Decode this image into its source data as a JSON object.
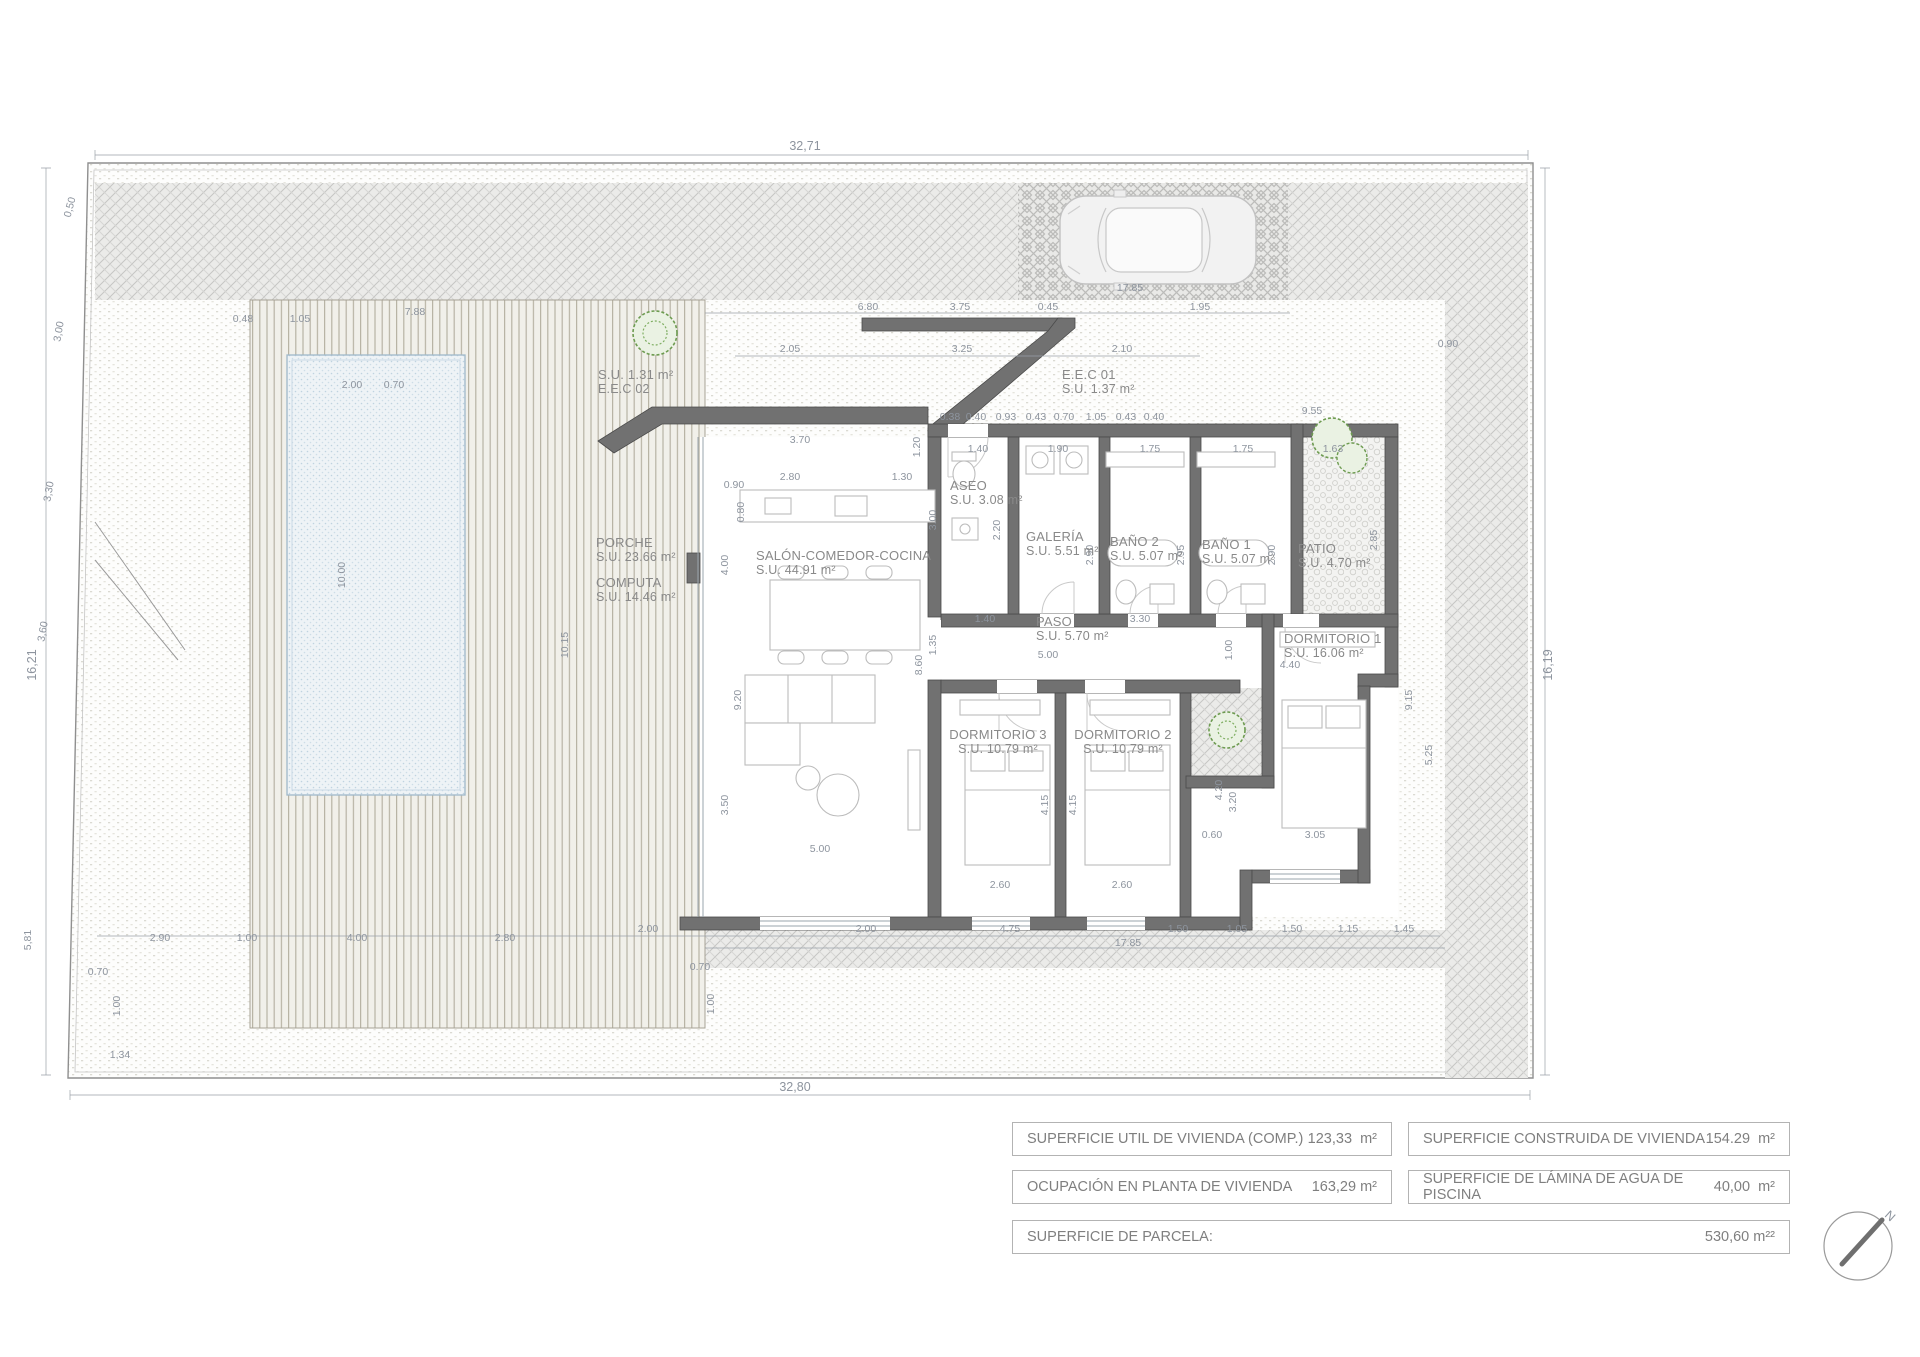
{
  "colors": {
    "wall_fill": "#717171",
    "wall_stroke": "#4a4a4a",
    "dimension_text": "#8d949e",
    "room_label_text": "#898989",
    "pool_fill": "#eef3f6",
    "pool_dot": "#bfd3e0",
    "deck_line": "#b7b3a4",
    "gravel_hatch": "#c6c6c4",
    "tree_green": "#5f8f45",
    "table_border": "#b3b3b3",
    "table_text": "#7f7f7f"
  },
  "icons": {
    "car": "car-top-view",
    "tree": "tree-canopy-plan",
    "compass": "north-arrow-compass"
  },
  "plan": {
    "compass_label": "N",
    "rooms": [
      {
        "n": "PORCHE",
        "s": "S.U. 23.66 m²",
        "x": 596,
        "y": 547
      },
      {
        "n": "COMPUTA",
        "s": "S.U. 14.46 m²",
        "x": 596,
        "y": 587
      },
      {
        "n": "SALÓN-COMEDOR-COCINA",
        "s": "S.U. 44.91 m²",
        "x": 756,
        "y": 560
      },
      {
        "n": "ASEO",
        "s": "S.U. 3.08 m²",
        "x": 950,
        "y": 490
      },
      {
        "n": "GALERÍA",
        "s": "S.U. 5.51 m²",
        "x": 1026,
        "y": 541
      },
      {
        "n": "BAÑO 2",
        "s": "S.U. 5.07 m²",
        "x": 1110,
        "y": 546
      },
      {
        "n": "BAÑO 1",
        "s": "S.U. 5.07 m²",
        "x": 1202,
        "y": 549
      },
      {
        "n": "PATIO",
        "s": "S.U. 4.70 m²",
        "x": 1298,
        "y": 553
      },
      {
        "n": "PASO",
        "s": "S.U. 5.70 m²",
        "x": 1036,
        "y": 626
      },
      {
        "n": "DORMITORIO 3",
        "s": "S.U. 10.79 m²",
        "x": 998,
        "y": 739,
        "a": "middle"
      },
      {
        "n": "DORMITORIO 2",
        "s": "S.U. 10.79 m²",
        "x": 1123,
        "y": 739,
        "a": "middle"
      },
      {
        "n": "DORMITORIO 1",
        "s": "S.U. 16.06 m²",
        "x": 1284,
        "y": 643
      },
      {
        "n": "E.E.C 01",
        "s": "S.U. 1.37 m²",
        "x": 1062,
        "y": 379
      },
      {
        "n": "S.U. 1.31 m²",
        "s": "E.E.C 02",
        "x": 598,
        "y": 379
      }
    ],
    "dims": [
      {
        "t": "32,71",
        "x": 805,
        "y": 150,
        "s": 12.5
      },
      {
        "t": "32,80",
        "x": 795,
        "y": 1091,
        "s": 12.5
      },
      {
        "t": "16,21",
        "x": 36,
        "y": 665,
        "r": -90,
        "s": 12.5
      },
      {
        "t": "16,19",
        "x": 1552,
        "y": 665,
        "r": -90,
        "s": 12.5
      },
      {
        "t": "0,50",
        "x": 73,
        "y": 208,
        "r": -75
      },
      {
        "t": "3,00",
        "x": 62,
        "y": 332,
        "r": -80
      },
      {
        "t": "3,30",
        "x": 52,
        "y": 492,
        "r": -80
      },
      {
        "t": "3,60",
        "x": 46,
        "y": 632,
        "r": -80
      },
      {
        "t": "5,81",
        "x": 31,
        "y": 940,
        "r": -90
      },
      {
        "t": "1,34",
        "x": 120,
        "y": 1058
      },
      {
        "t": "17.85",
        "x": 1130,
        "y": 291
      },
      {
        "t": "6.80",
        "x": 868,
        "y": 310
      },
      {
        "t": "3.75",
        "x": 960,
        "y": 310
      },
      {
        "t": "0.45",
        "x": 1048,
        "y": 310
      },
      {
        "t": "1.95",
        "x": 1200,
        "y": 310
      },
      {
        "t": "2.05",
        "x": 790,
        "y": 352
      },
      {
        "t": "3.25",
        "x": 962,
        "y": 352
      },
      {
        "t": "2.10",
        "x": 1122,
        "y": 352
      },
      {
        "t": "0.90",
        "x": 1448,
        "y": 347
      },
      {
        "t": "9.55",
        "x": 1312,
        "y": 414
      },
      {
        "t": "0.48",
        "x": 243,
        "y": 322
      },
      {
        "t": "1.05",
        "x": 300,
        "y": 322
      },
      {
        "t": "7.88",
        "x": 415,
        "y": 315
      },
      {
        "t": "2.00",
        "x": 352,
        "y": 388
      },
      {
        "t": "0.70",
        "x": 394,
        "y": 388
      },
      {
        "t": "0.38",
        "x": 950,
        "y": 420
      },
      {
        "t": "0.40",
        "x": 976,
        "y": 420
      },
      {
        "t": "0.93",
        "x": 1006,
        "y": 420
      },
      {
        "t": "0.43",
        "x": 1036,
        "y": 420
      },
      {
        "t": "0.70",
        "x": 1064,
        "y": 420
      },
      {
        "t": "1.05",
        "x": 1096,
        "y": 420
      },
      {
        "t": "0.43",
        "x": 1126,
        "y": 420
      },
      {
        "t": "0.40",
        "x": 1154,
        "y": 420
      },
      {
        "t": "1.40",
        "x": 978,
        "y": 452
      },
      {
        "t": "1.90",
        "x": 1058,
        "y": 452
      },
      {
        "t": "1.75",
        "x": 1150,
        "y": 452
      },
      {
        "t": "1.75",
        "x": 1243,
        "y": 452
      },
      {
        "t": "1.63",
        "x": 1333,
        "y": 452
      },
      {
        "t": "3.00",
        "x": 936,
        "y": 520,
        "r": -90
      },
      {
        "t": "2.20",
        "x": 1000,
        "y": 530,
        "r": -90
      },
      {
        "t": "2.90",
        "x": 1093,
        "y": 555,
        "r": -90
      },
      {
        "t": "2.95",
        "x": 1184,
        "y": 555,
        "r": -90
      },
      {
        "t": "2.90",
        "x": 1275,
        "y": 555,
        "r": -90
      },
      {
        "t": "2.85",
        "x": 1377,
        "y": 540,
        "r": -90
      },
      {
        "t": "3.70",
        "x": 800,
        "y": 443
      },
      {
        "t": "2.80",
        "x": 790,
        "y": 480
      },
      {
        "t": "0.90",
        "x": 734,
        "y": 488
      },
      {
        "t": "1.30",
        "x": 902,
        "y": 480
      },
      {
        "t": "1.20",
        "x": 920,
        "y": 447,
        "r": -90
      },
      {
        "t": "0.80",
        "x": 744,
        "y": 512,
        "r": -90
      },
      {
        "t": "4.00",
        "x": 728,
        "y": 565,
        "r": -90
      },
      {
        "t": "9.20",
        "x": 741,
        "y": 700,
        "r": -90
      },
      {
        "t": "10.15",
        "x": 568,
        "y": 645,
        "r": -90
      },
      {
        "t": "8.60",
        "x": 922,
        "y": 665,
        "r": -90
      },
      {
        "t": "3.50",
        "x": 728,
        "y": 805,
        "r": -90
      },
      {
        "t": "5.00",
        "x": 820,
        "y": 852
      },
      {
        "t": "1.40",
        "x": 985,
        "y": 622
      },
      {
        "t": "3.30",
        "x": 1140,
        "y": 622
      },
      {
        "t": "5.00",
        "x": 1048,
        "y": 658
      },
      {
        "t": "1.35",
        "x": 936,
        "y": 645,
        "r": -90
      },
      {
        "t": "4.15",
        "x": 1048,
        "y": 805,
        "r": -90
      },
      {
        "t": "4.15",
        "x": 1076,
        "y": 805,
        "r": -90
      },
      {
        "t": "2.60",
        "x": 1000,
        "y": 888
      },
      {
        "t": "2.60",
        "x": 1122,
        "y": 888
      },
      {
        "t": "4.40",
        "x": 1290,
        "y": 668
      },
      {
        "t": "1.00",
        "x": 1232,
        "y": 650,
        "r": -90
      },
      {
        "t": "4.20",
        "x": 1222,
        "y": 790,
        "r": -90
      },
      {
        "t": "3.20",
        "x": 1236,
        "y": 802,
        "r": -90
      },
      {
        "t": "0.60",
        "x": 1212,
        "y": 838
      },
      {
        "t": "3.05",
        "x": 1315,
        "y": 838
      },
      {
        "t": "9.15",
        "x": 1412,
        "y": 700,
        "r": -90
      },
      {
        "t": "5.25",
        "x": 1432,
        "y": 755,
        "r": -90
      },
      {
        "t": "2.00",
        "x": 648,
        "y": 932
      },
      {
        "t": "2.00",
        "x": 866,
        "y": 932
      },
      {
        "t": "4.75",
        "x": 1010,
        "y": 932
      },
      {
        "t": "1.50",
        "x": 1178,
        "y": 932
      },
      {
        "t": "1.05",
        "x": 1237,
        "y": 932
      },
      {
        "t": "1.50",
        "x": 1292,
        "y": 932
      },
      {
        "t": "1.15",
        "x": 1348,
        "y": 932
      },
      {
        "t": "1.45",
        "x": 1404,
        "y": 932
      },
      {
        "t": "17.85",
        "x": 1128,
        "y": 946
      },
      {
        "t": "0.70",
        "x": 700,
        "y": 970
      },
      {
        "t": "1.00",
        "x": 714,
        "y": 1004,
        "r": -90
      },
      {
        "t": "0.70",
        "x": 98,
        "y": 975
      },
      {
        "t": "1.00",
        "x": 120,
        "y": 1006,
        "r": -90
      },
      {
        "t": "2.90",
        "x": 160,
        "y": 941
      },
      {
        "t": "1.00",
        "x": 247,
        "y": 941
      },
      {
        "t": "4.00",
        "x": 357,
        "y": 941
      },
      {
        "t": "2.80",
        "x": 505,
        "y": 941
      },
      {
        "t": "10.00",
        "x": 345,
        "y": 575,
        "r": -90
      }
    ]
  },
  "summary": {
    "rows": [
      {
        "label": "SUPERFICIE UTIL  DE VIVIENDA (COMP.)",
        "value": "123,33  m²"
      },
      {
        "label": "SUPERFICIE CONSTRUIDA DE VIVIENDA",
        "value": "154.29  m²"
      },
      {
        "label": "OCUPACIÓN EN PLANTA DE VIVIENDA",
        "value": "163,29 m²"
      },
      {
        "label": "SUPERFICIE DE LÁMINA DE AGUA DE PISCINA",
        "value": "40,00  m²"
      },
      {
        "label": "SUPERFICIE DE PARCELA:",
        "value": "530,60 m²²"
      }
    ]
  }
}
